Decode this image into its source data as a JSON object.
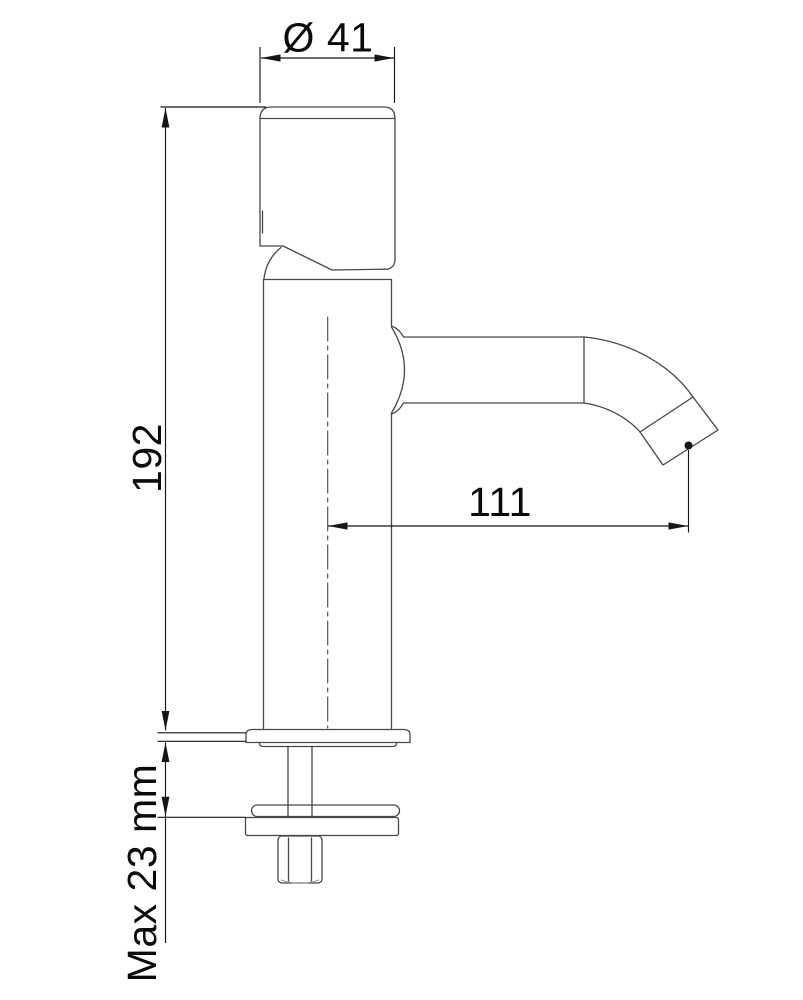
{
  "drawing": {
    "subject": "single-lever-basin-tap-side-elevation",
    "background_color": "#ffffff",
    "outline_color": "#474747",
    "dimension_color": "#161616",
    "dimensions": {
      "diameter_top": {
        "label": "Ø 41",
        "value": 41,
        "unit": "mm"
      },
      "height": {
        "label": "192",
        "value": 192,
        "unit": "mm"
      },
      "spout_reach": {
        "label": "111",
        "value": 111,
        "unit": "mm"
      },
      "deck_thickness": {
        "label": "Max 23 mm",
        "value": 23,
        "unit": "mm"
      }
    },
    "parts": [
      "handle-cap",
      "lever",
      "body",
      "spout",
      "aerator-tip",
      "base-flange",
      "threaded-shank",
      "rubber-washer",
      "metal-washer",
      "hex-nut"
    ]
  }
}
